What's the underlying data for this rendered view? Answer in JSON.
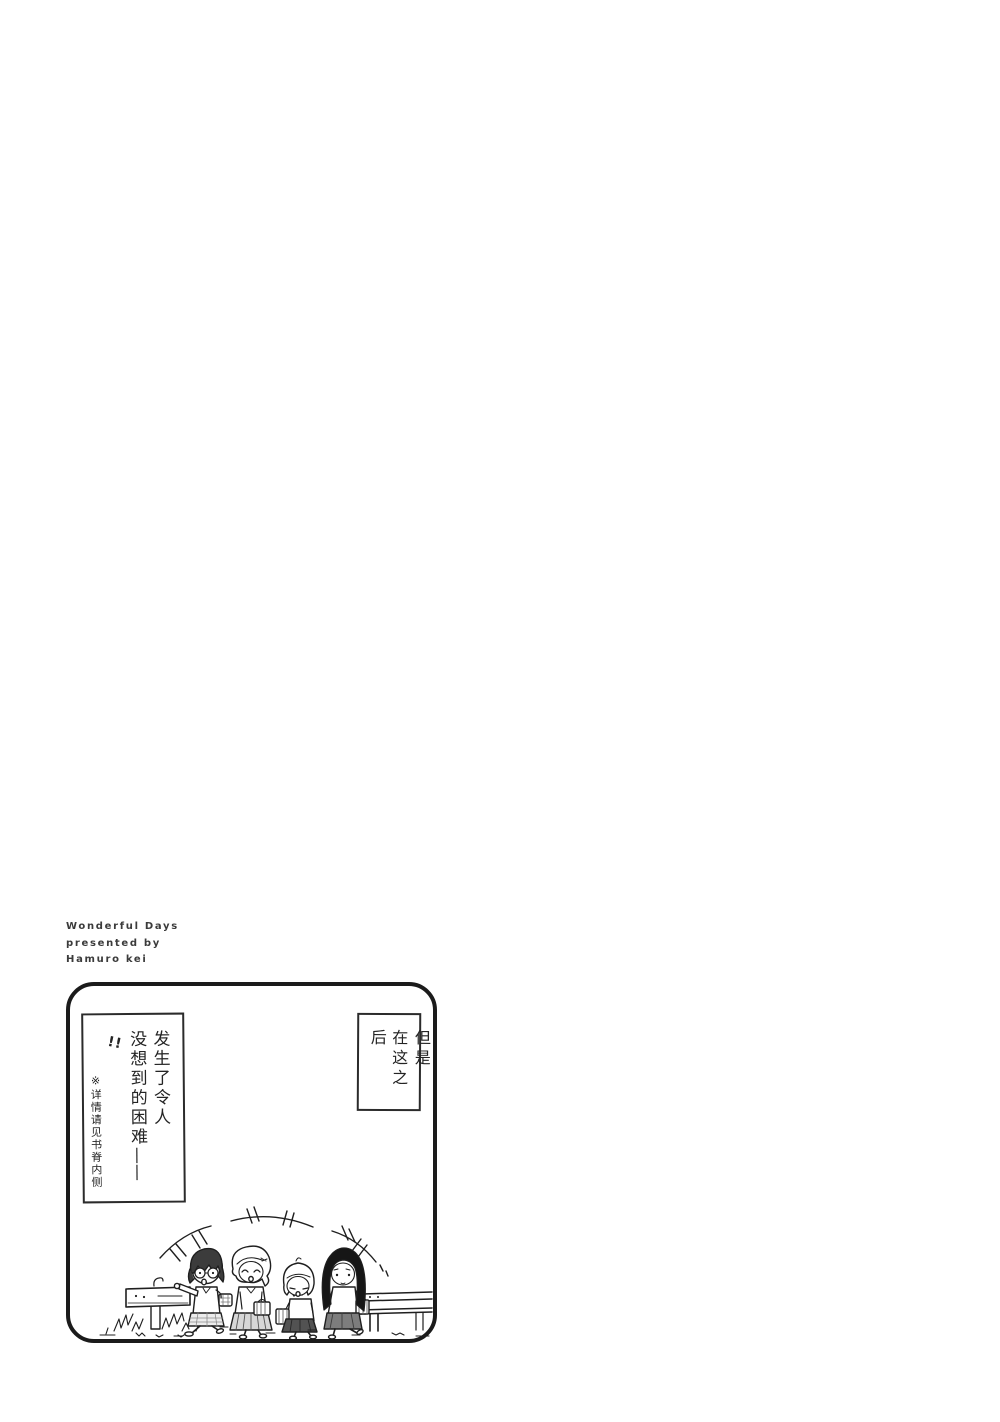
{
  "colors": {
    "paper": "#ffffff",
    "ink": "#1f1f1f",
    "credit_text": "#3b3b3b"
  },
  "credit": {
    "line1": "Wonderful Days",
    "line2": "presented by",
    "line3": "Hamuro kei"
  },
  "panel": {
    "left_caption": {
      "line1": "发生了令人",
      "line2": "没想到的困难",
      "dash": "——",
      "exclamations": "!!",
      "footnote": "※详情请见书脊内侧"
    },
    "right_caption": {
      "line1": "但是",
      "line2": "在这之后"
    }
  }
}
